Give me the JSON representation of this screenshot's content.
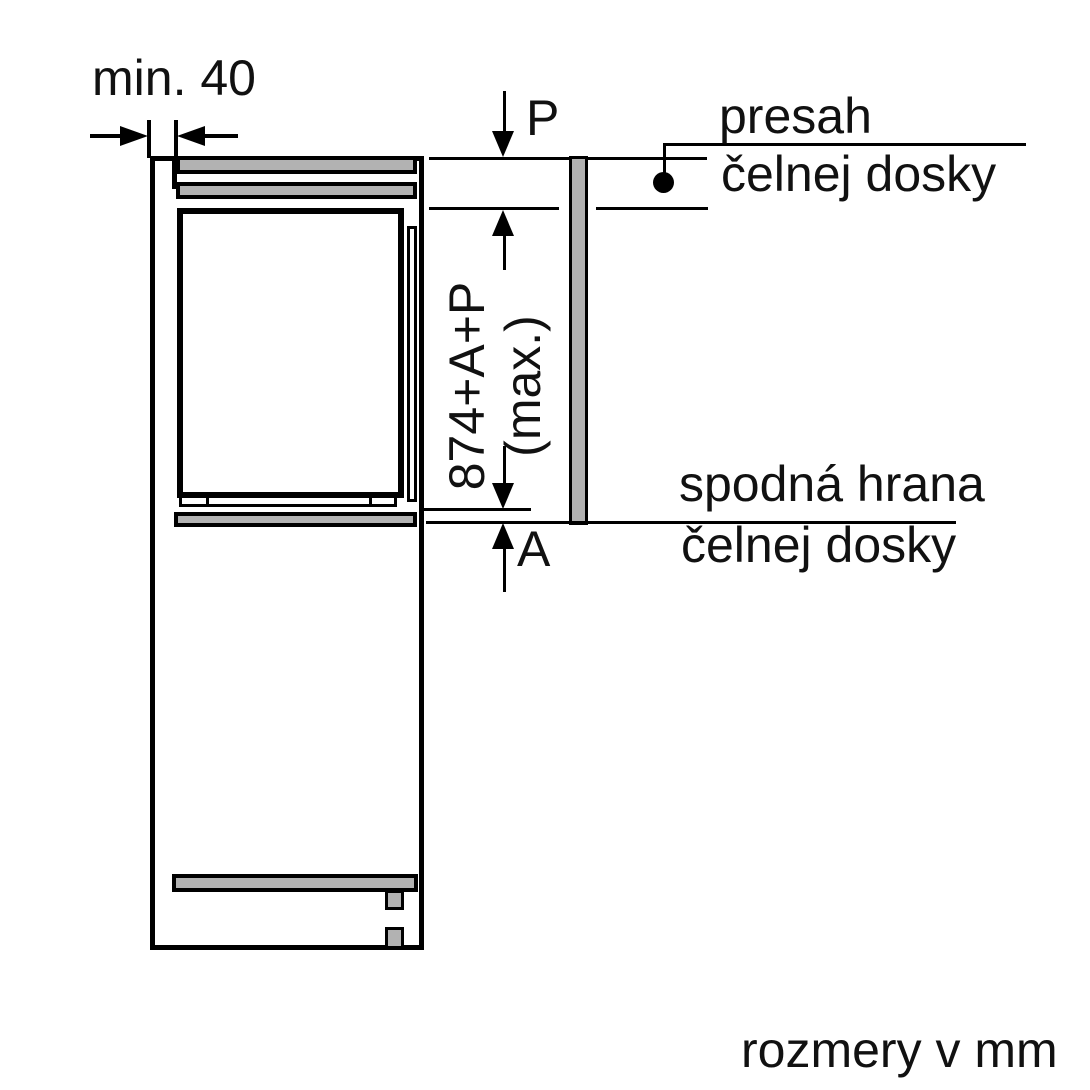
{
  "title": "appliance installation dimension diagram",
  "units_note": "rozmery v mm",
  "dimensions": {
    "min_gap": "min. 40",
    "top_overhang": "P",
    "bottom_gap": "A",
    "niche_formula_line1": "874+A+P",
    "niche_formula_line2": "(max.)"
  },
  "annotations": {
    "overhang": {
      "line1": "presah",
      "line2": "čelnej dosky"
    },
    "bottom_edge": {
      "line1": "spodná hrana",
      "line2": "čelnej dosky"
    }
  },
  "colors": {
    "line": "#000000",
    "panel_fill": "#b2b2b2",
    "background": "#ffffff",
    "text": "#111111"
  }
}
